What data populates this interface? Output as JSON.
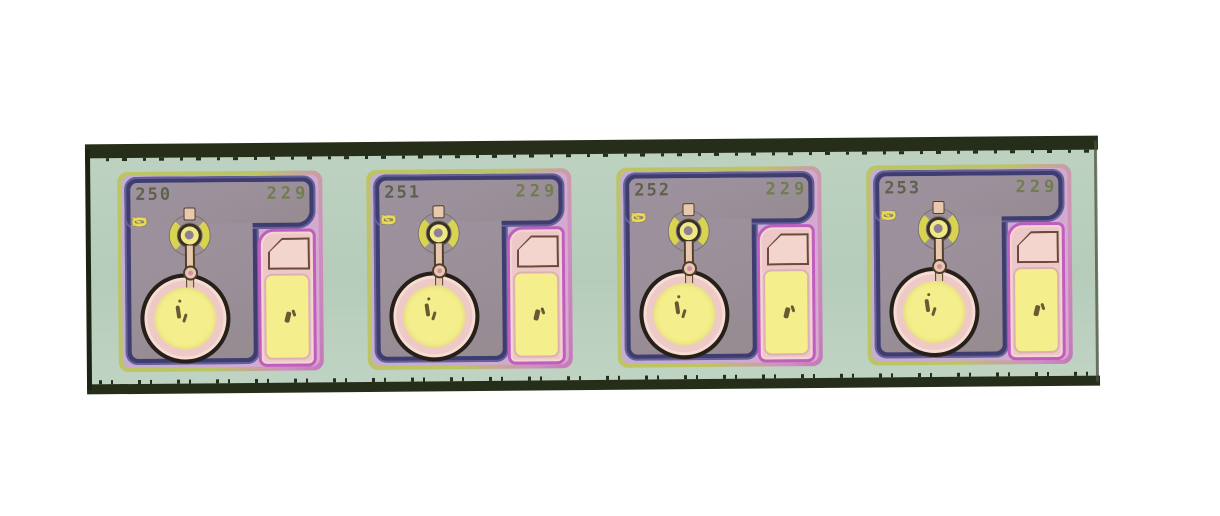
{
  "canvas": {
    "background": "#ffffff"
  },
  "strip": {
    "kind": "diced-wafer-strip"
  },
  "colors": {
    "mint": "#b6ccba",
    "edge-dark": "#262e1a",
    "edge-left": "#1d2314",
    "edge-right": "#47503a",
    "die-green": "#bcc464",
    "die-pink": "#cf8fc0",
    "lavender": "#c2aed4",
    "frame-blue": "#3e3c70",
    "field-gray": "#9b8f9a",
    "magenta": "#c05ec0",
    "pad-pink": "#eec7c9",
    "pale-pad": "#f3d5ce",
    "pad-outline": "#6b4a3c",
    "pad-yellow": "#f4ef8c",
    "pad-yellow-border": "#ddb0b4",
    "digit-olive": "#5e624c",
    "digit-green": "#717c52",
    "digit-yellow": "#e9da57",
    "metal-tan": "#e9c9ae",
    "metal-outline": "#4f3e2d",
    "arc-yellow": "#d8d44f",
    "ring-yellow": "#f0e883",
    "hole-gray": "#8e8290",
    "circle-black": "#262019",
    "circle-pink": "#eecac6",
    "mark-dark": "#43351f"
  },
  "dies": [
    {
      "serial": "250",
      "code": "229",
      "vertical_digits": [
        "2",
        "2",
        "0"
      ]
    },
    {
      "serial": "251",
      "code": "229",
      "vertical_digits": [
        "2",
        "2",
        "0"
      ]
    },
    {
      "serial": "252",
      "code": "229",
      "vertical_digits": [
        "2",
        "2",
        "0"
      ]
    },
    {
      "serial": "253",
      "code": "229",
      "vertical_digits": [
        "2",
        "2",
        "0"
      ]
    }
  ]
}
